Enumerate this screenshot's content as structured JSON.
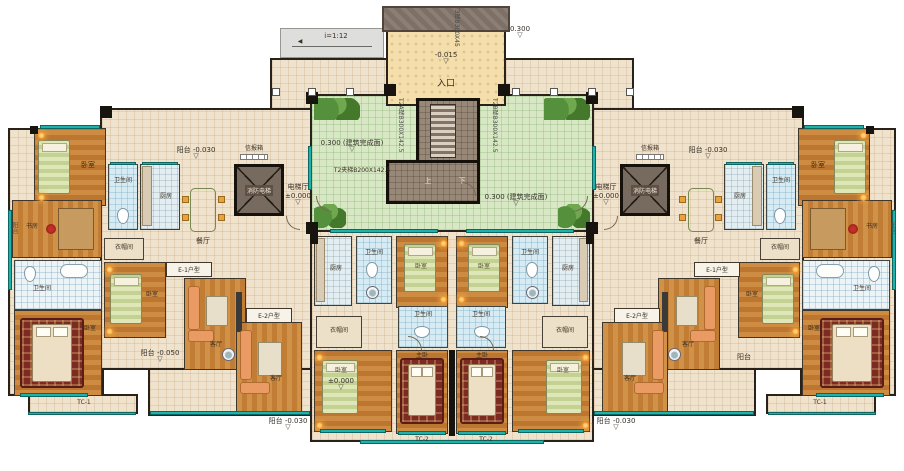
{
  "labels": {
    "bedroom": "卧室",
    "master_bedroom": "主卧",
    "living_room": "客厅",
    "dining_room": "餐厅",
    "kitchen": "厨房",
    "bathroom": "卫生间",
    "study": "书房",
    "closet": "衣帽间",
    "balcony": "阳台",
    "elevator_hall": "电梯厅",
    "fire_elevator": "消防电梯",
    "mailbox": "信报箱",
    "entrance": "入口",
    "up": "上",
    "down": "下"
  },
  "levels": {
    "courtyard": "0.300 (建筑完成面)",
    "zero": "±0.000",
    "entrance": "-0.015",
    "canopy": "0.300",
    "balcony_top": "阳台 -0.030",
    "balcony_bottom": "阳台 -0.030",
    "balcony_mid": "阳台 -0.050"
  },
  "units": {
    "e1": "E-1户型",
    "e2": "E-2户型"
  },
  "stairs": {
    "t3": "T3梯B300X45",
    "t2a": "T2A梯B300X142.5",
    "t2b": "T2B梯B300X142.5",
    "mid": "T2夹梯B200X142.5"
  },
  "ramp": {
    "slope": "i=1:12"
  },
  "codes": {
    "tc1": "TC-1",
    "tc2": "TC-2"
  },
  "icons": {
    "level_marker": "▽",
    "ramp_arrow": "◀"
  },
  "colors": {
    "wood": "#c98a45",
    "corridor": "#f0e3cf",
    "bath_tile": "#d6e9f0",
    "courtyard": "#d7e7c5",
    "teal_rail": "#1fb1ab",
    "wall": "#1d1915",
    "canopy": "#7b6d63",
    "elevator": "#6f6157",
    "accent_orange": "#e08a3c",
    "rug_red": "#7e2a22",
    "bed_green": "#ccd9a0"
  }
}
